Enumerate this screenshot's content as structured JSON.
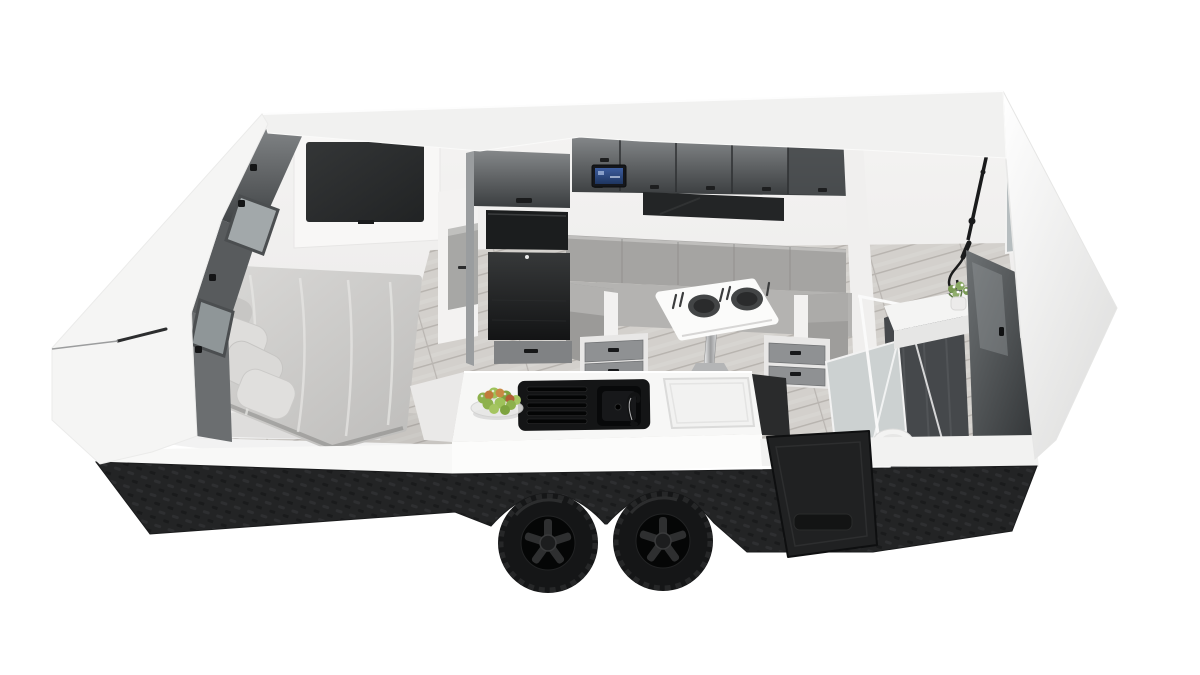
{
  "scene": {
    "title": "3D cutaway floor plan render of a caravan travel trailer interior",
    "description": "Isometric aerial cutaway render on a white background: left bedroom with grey double bed, pillows and wall-mounted TV; centre kitchen with tall appliance tower, glossy overhead lockers with blue radio display, U-shaped dinette lounge, pedestal table with two place settings, island bench with black sink, mixer tap, bowl of apples and flush cooktop lid; rear right bathroom with black rail shower, glass screens, vanity with flowers, tall glossy cabinet and toilet; black checker-plate skirt with twin dark alloy wheels and fold-down step panel.",
    "background_color": "#ffffff",
    "view": "isometric aerial cutaway"
  },
  "palette": {
    "shell_white": "#f5f5f4",
    "interior_wall": "#f1f0ef",
    "floor_wood_gray": "#d3d0cc",
    "cabinet_gloss_dark": "#4a4d4f",
    "appliance_black": "#1b1d1e",
    "upholstery_gray": "#aeadab",
    "bedding_gray": "#c9c8c6",
    "chassis_black": "#242526",
    "fixture_black": "#1a1b1c",
    "apple_green": "#8db14c",
    "apple_orange": "#c07a3b",
    "stereo_screen_blue": "#2f4f8f",
    "glass_tint": "#b6bdbf",
    "chrome": "#c9cacb"
  },
  "rooms": {
    "bedroom": {
      "label": "Bedroom",
      "items": [
        "double bed with grey duvet",
        "four pillows",
        "wall-mounted TV",
        "overhead lockers with latches",
        "tinted windows in cut wall"
      ]
    },
    "kitchen": {
      "label": "Kitchen and dinette",
      "items": [
        "tall tower with microwave and fridge",
        "glossy overhead lockers",
        "radio unit with blue display",
        "dark splashback",
        "U-shaped dinette lounge",
        "white pedestal table with two dark plates and cutlery",
        "under-seat drawers",
        "island bench with black sink, drainer and tap",
        "bowl of green and orange apples",
        "flush cooktop lid"
      ]
    },
    "bathroom": {
      "label": "Bathroom",
      "items": [
        "black rail shower with hose",
        "glass shower screens",
        "shower tray",
        "vanity with flower posy",
        "tall glossy cabinet",
        "triangular mirror panel",
        "toilet"
      ]
    },
    "exterior": {
      "label": "Exterior",
      "items": [
        "white body shell",
        "black checker-plate skirt",
        "twin dark alloy wheels",
        "fold-down entry step panel",
        "dark trim line on front corner"
      ]
    }
  }
}
